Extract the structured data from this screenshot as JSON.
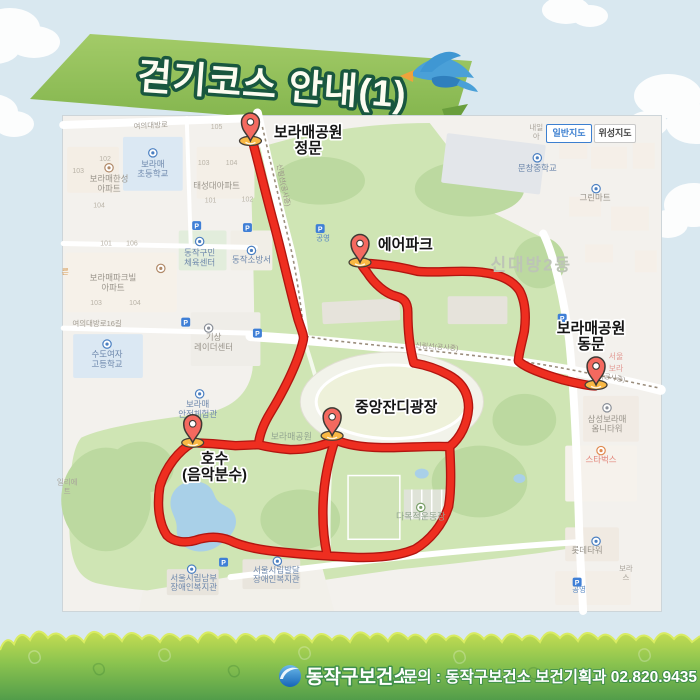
{
  "banner": {
    "title": "걷기코스 안내(1)"
  },
  "map": {
    "controls": [
      {
        "label": "일반지도",
        "active": true
      },
      {
        "label": "위성지도",
        "active": false
      }
    ],
    "markers": [
      {
        "name": "boramae-main-gate",
        "x": 250,
        "y": 140,
        "lines": [
          "보라매공원",
          "정문"
        ],
        "lx": 308,
        "ly": 136,
        "anchor": "middle"
      },
      {
        "name": "air-park",
        "x": 360,
        "y": 262,
        "lines": [
          "에어파크"
        ],
        "lx": 378,
        "ly": 249,
        "anchor": "start"
      },
      {
        "name": "boramae-east-gate",
        "x": 597,
        "y": 385,
        "lines": [
          "보라매공원",
          "동문"
        ],
        "lx": 592,
        "ly": 333,
        "anchor": "middle"
      },
      {
        "name": "central-lawn-plaza",
        "x": 332,
        "y": 436,
        "lines": [
          "중앙잔디광장"
        ],
        "lx": 355,
        "ly": 412,
        "anchor": "start"
      },
      {
        "name": "lake-music-fountain",
        "x": 192,
        "y": 443,
        "lines": [
          "호수",
          "(음악분수)"
        ],
        "lx": 214,
        "ly": 464,
        "anchor": "middle"
      }
    ],
    "labels": [
      {
        "t": [
          "보라매",
          "초등학교"
        ],
        "x": 152,
        "y": 166,
        "c": "blue"
      },
      {
        "t": [
          "보라매한성",
          "아파트"
        ],
        "x": 108,
        "y": 181,
        "c": "gray"
      },
      {
        "t": [
          "태성대아파트"
        ],
        "x": 216,
        "y": 188,
        "c": "gray"
      },
      {
        "t": [
          "보라매파크빌",
          "아파트"
        ],
        "x": 112,
        "y": 280,
        "c": "gray"
      },
      {
        "t": [
          "여의대방로16길"
        ],
        "x": 96,
        "y": 326,
        "c": "road"
      },
      {
        "t": [
          "수도여자",
          "고등학교"
        ],
        "x": 106,
        "y": 357,
        "c": "blue"
      },
      {
        "t": [
          "동작구민",
          "체육센터"
        ],
        "x": 199,
        "y": 255,
        "c": "blue"
      },
      {
        "t": [
          "동작소방서"
        ],
        "x": 251,
        "y": 262,
        "c": "blue"
      },
      {
        "t": [
          "기상",
          "레이더센터"
        ],
        "x": 213,
        "y": 340,
        "c": "gray"
      },
      {
        "t": [
          "보라매",
          "안전체험관"
        ],
        "x": 197,
        "y": 407,
        "c": "blue"
      },
      {
        "t": [
          "보라매공원"
        ],
        "x": 291,
        "y": 440,
        "c": "green"
      },
      {
        "t": [
          "신대방2동"
        ],
        "x": 532,
        "y": 270,
        "c": "big"
      },
      {
        "t": [
          "문창중학교"
        ],
        "x": 538,
        "y": 170,
        "c": "blue"
      },
      {
        "t": [
          "그린마트"
        ],
        "x": 596,
        "y": 200,
        "c": "gray"
      },
      {
        "t": [
          "다목적운동장"
        ],
        "x": 421,
        "y": 520,
        "c": "green"
      },
      {
        "t": [
          "삼성보라매",
          "옴니타워"
        ],
        "x": 608,
        "y": 422,
        "c": "gray"
      },
      {
        "t": [
          "스타벅스"
        ],
        "x": 602,
        "y": 463,
        "c": "red"
      },
      {
        "t": [
          "롯데타워"
        ],
        "x": 588,
        "y": 554,
        "c": "gray"
      },
      {
        "t": [
          "공영"
        ],
        "x": 580,
        "y": 593,
        "c": "blue2"
      },
      {
        "t": [
          "공영"
        ],
        "x": 323,
        "y": 240,
        "c": "blue2"
      },
      {
        "t": [
          "서울시립남부",
          "장애인복지관"
        ],
        "x": 193,
        "y": 582,
        "c": "blue",
        "lh": 9
      },
      {
        "t": [
          "서울시립발달",
          "장애인복지관"
        ],
        "x": 276,
        "y": 574,
        "c": "blue",
        "lh": 9
      },
      {
        "t": [
          "여의대방로"
        ],
        "x": 150,
        "y": 127,
        "c": "road",
        "r": -3
      },
      {
        "t": [
          "신림선(공사중)"
        ],
        "x": 437,
        "y": 349,
        "c": "rail",
        "r": 4
      },
      {
        "t": [
          "신림선(공사중)"
        ],
        "x": 281,
        "y": 185,
        "c": "rail",
        "r": 78
      },
      {
        "t": [
          "(공사중)"
        ],
        "x": 614,
        "y": 380,
        "c": "rail",
        "r": 10
      },
      {
        "t": [
          "내일",
          "아"
        ],
        "x": 537,
        "y": 129,
        "c": "tiny",
        "lh": 9
      },
      {
        "t": [
          "서울",
          "보라"
        ],
        "x": 617,
        "y": 359,
        "c": "redfrag",
        "lh": 12
      },
      {
        "t": [
          "일리에",
          "트"
        ],
        "x": 66,
        "y": 485,
        "c": "tiny",
        "lh": 9
      },
      {
        "t": [
          "른"
        ],
        "x": 64,
        "y": 274,
        "c": "orangefrag"
      },
      {
        "t": [
          "보라",
          "스"
        ],
        "x": 627,
        "y": 572,
        "c": "tiny",
        "lh": 9
      },
      {
        "t": [
          "105"
        ],
        "x": 216,
        "y": 128,
        "c": "num"
      },
      {
        "t": [
          "103"
        ],
        "x": 203,
        "y": 164,
        "c": "num"
      },
      {
        "t": [
          "104"
        ],
        "x": 231,
        "y": 164,
        "c": "num"
      },
      {
        "t": [
          "101"
        ],
        "x": 210,
        "y": 202,
        "c": "num"
      },
      {
        "t": [
          "102"
        ],
        "x": 247,
        "y": 201,
        "c": "num"
      },
      {
        "t": [
          "102"
        ],
        "x": 104,
        "y": 160,
        "c": "num"
      },
      {
        "t": [
          "103"
        ],
        "x": 77,
        "y": 172,
        "c": "num"
      },
      {
        "t": [
          "104"
        ],
        "x": 98,
        "y": 207,
        "c": "num"
      },
      {
        "t": [
          "101"
        ],
        "x": 105,
        "y": 245,
        "c": "num"
      },
      {
        "t": [
          "106"
        ],
        "x": 131,
        "y": 245,
        "c": "num"
      },
      {
        "t": [
          "103"
        ],
        "x": 95,
        "y": 305,
        "c": "num"
      },
      {
        "t": [
          "104"
        ],
        "x": 134,
        "y": 305,
        "c": "num"
      }
    ],
    "icons": [
      {
        "x": 152,
        "y": 152,
        "k": "poi",
        "col": "#4a7fc1"
      },
      {
        "x": 108,
        "y": 167,
        "k": "poi",
        "col": "#b08968"
      },
      {
        "x": 160,
        "y": 268,
        "k": "poi",
        "col": "#b08968"
      },
      {
        "x": 106,
        "y": 344,
        "k": "poi",
        "col": "#4a7fc1"
      },
      {
        "x": 199,
        "y": 241,
        "k": "poi",
        "col": "#4a7fc1"
      },
      {
        "x": 251,
        "y": 250,
        "k": "poi",
        "col": "#4a7fc1"
      },
      {
        "x": 208,
        "y": 328,
        "k": "poi",
        "col": "#8a8f98"
      },
      {
        "x": 199,
        "y": 394,
        "k": "poi",
        "col": "#4a7fc1"
      },
      {
        "x": 538,
        "y": 157,
        "k": "poi",
        "col": "#4a7fc1"
      },
      {
        "x": 597,
        "y": 188,
        "k": "poi",
        "col": "#4a7fc1"
      },
      {
        "x": 608,
        "y": 408,
        "k": "poi",
        "col": "#8a8f98"
      },
      {
        "x": 602,
        "y": 451,
        "k": "poi",
        "col": "#e08a50"
      },
      {
        "x": 597,
        "y": 542,
        "k": "poi",
        "col": "#4a7fc1"
      },
      {
        "x": 421,
        "y": 508,
        "k": "poi",
        "col": "#7aa06a"
      },
      {
        "x": 191,
        "y": 570,
        "k": "poi",
        "col": "#4a7fc1"
      },
      {
        "x": 277,
        "y": 562,
        "k": "poi",
        "col": "#4a7fc1"
      },
      {
        "x": 196,
        "y": 225,
        "k": "parking"
      },
      {
        "x": 247,
        "y": 227,
        "k": "parking"
      },
      {
        "x": 185,
        "y": 322,
        "k": "parking"
      },
      {
        "x": 257,
        "y": 333,
        "k": "parking"
      },
      {
        "x": 320,
        "y": 228,
        "k": "parking"
      },
      {
        "x": 563,
        "y": 318,
        "k": "parking"
      },
      {
        "x": 223,
        "y": 563,
        "k": "parking"
      },
      {
        "x": 578,
        "y": 583,
        "k": "parking"
      }
    ]
  },
  "footer": {
    "org": "동작구보건소",
    "contact": "문의 : 동작구보건소 보건기획과 02.820.9435"
  },
  "theme": {
    "css_vars": {
      "--c-sky": "#d9e8f0",
      "--c-banner1": "#a3cb68",
      "--c-banner2": "#7fb24a",
      "--c-route": "#ee2e20",
      "--c-route-edge": "#b21510",
      "--c-pin": "#f4695f",
      "--c-pinbase": "#f9b844",
      "--c-park": "#cfe5b4",
      "--c-water": "#a9d0e8",
      "--c-grass-top": "#c6dd52",
      "--c-grass-mid": "#8cc44f",
      "--c-grass-bot": "#529d4a",
      "--c-btn-active": "#3c7fd0"
    }
  }
}
